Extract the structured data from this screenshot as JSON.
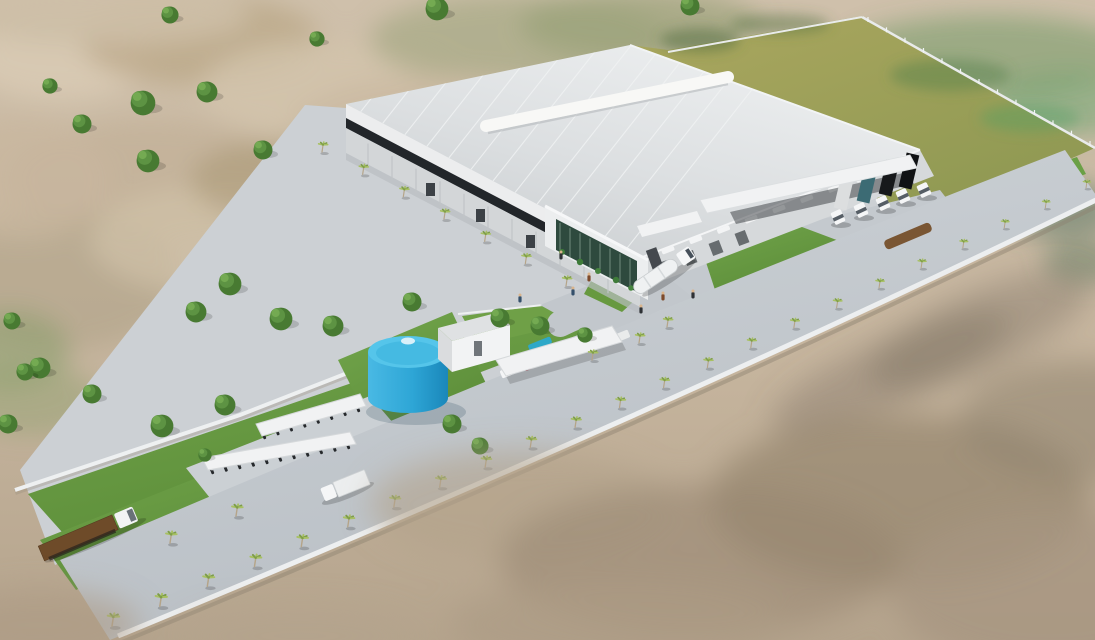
{
  "scene": {
    "type": "3d-architectural-aerial-render",
    "description": "Aerial 3D rendering of an industrial warehouse facility: white standing-seam roof with ridge ventilator, glass entrance atrium, loading docks with semi trucks, blue cylindrical water tank, pump house, carports, motorcycle canopies, palm-lined perimeter boulevard with white wall, olive expansion field and blurred sandy scrubland terrain",
    "palette": {
      "sand_base": "#c6b59e",
      "sand_light": "#d9cbb5",
      "sand_dark": "#a3927a",
      "sand_green": "#97a47c",
      "field_olive": "#a7a35c",
      "field_olive_dark": "#8b9751",
      "lawn_green": "#67993f",
      "lawn_light": "#7fae57",
      "lawn_dark": "#4f7f33",
      "road_gray": "#c4c9ce",
      "pad_gray": "#cbd0d4",
      "roof_light": "#e9ebec",
      "roof_shadow": "#c7cbce",
      "roof_seam": "#f0f2f3",
      "ridge_vent_white": "#f8f8f6",
      "fascia_white": "#ecedee",
      "glazing_dark": "#22262a",
      "wall_light": "#d6d9db",
      "pilaster_gray": "#c0c4c7",
      "glass_green": "#2e4a3e",
      "mullion_light": "#a9c2b2",
      "plant_green": "#3e7b39",
      "canopy_white": "#f1f2f3",
      "tank_blue_top": "#55c5ea",
      "tank_blue": "#2ea6d6",
      "tank_blue_dark": "#1786b8",
      "palm_frond": "#a8c162",
      "palm_frond_dark": "#7d9d49",
      "palm_trunk": "#b5a488",
      "tree_green": "#5d9343",
      "tree_green_dark": "#487a32",
      "tree_green_light": "#74aa52",
      "truck_white": "#f5f6f7",
      "trailer_teal": "#3c6b74",
      "trailer_black": "#17191b",
      "trailer_gray": "#dcdedf",
      "trailer_brown": "#6e4b29",
      "hedge_brown": "#7a5633",
      "perimeter_wall_white": "#edeff0",
      "shade_canopy_blue": "#2ea8c8",
      "people_dark": "#2e3135"
    },
    "objects": {
      "warehouse": {
        "label": "main warehouse building",
        "features": [
          "standing-seam metal roof",
          "ridge ventilator",
          "dark clerestory glazing band",
          "glass entrance atrium with vertical garden",
          "loading docks with canopy"
        ]
      },
      "loading_dock": {
        "truck_count": 6,
        "trailer_colors": [
          "gray",
          "teal",
          "black",
          "black"
        ]
      },
      "water_tank": {
        "shape": "cylindrical",
        "color": "blue"
      },
      "pump_house": {
        "color": "white"
      },
      "carport": {
        "car_count": 6
      },
      "motorcycle_canopies": {
        "count": 2
      },
      "flatbed_truck": {
        "trailer_color": "brown"
      },
      "box_truck": {
        "color": "white"
      },
      "tanker_truck": {
        "color": "white"
      },
      "perimeter_road": {
        "palm_count": 23,
        "wall": "white masonry"
      },
      "expansion_field": {
        "color": "olive-green",
        "fenced": true
      },
      "terrain": {
        "type": "sandy scrubland with scattered trees, foreground depth-of-field blur"
      }
    }
  },
  "placements": {
    "terrain_trees": [
      [
        143,
        103,
        13
      ],
      [
        207,
        92,
        11
      ],
      [
        82,
        124,
        10
      ],
      [
        148,
        161,
        12
      ],
      [
        50,
        86,
        8
      ],
      [
        263,
        150,
        10
      ],
      [
        230,
        284,
        12
      ],
      [
        196,
        312,
        11
      ],
      [
        281,
        319,
        12
      ],
      [
        40,
        368,
        11
      ],
      [
        92,
        394,
        10
      ],
      [
        12,
        321,
        9
      ],
      [
        437,
        9,
        12
      ],
      [
        690,
        6,
        10
      ],
      [
        170,
        15,
        9
      ],
      [
        317,
        39,
        8
      ],
      [
        8,
        424,
        10
      ],
      [
        25,
        372,
        9
      ]
    ],
    "site_trees": [
      [
        333,
        326,
        11
      ],
      [
        412,
        302,
        10
      ],
      [
        500,
        318,
        10
      ],
      [
        540,
        326,
        10
      ],
      [
        452,
        424,
        10
      ],
      [
        480,
        446,
        9
      ],
      [
        162,
        426,
        12
      ],
      [
        225,
        405,
        11
      ],
      [
        585,
        335,
        8
      ],
      [
        205,
        455,
        7
      ]
    ],
    "palms_main": {
      "p0": [
        112,
        626
      ],
      "p1": [
        640,
        408
      ],
      "p2": [
        1086,
        188
      ],
      "count": 23
    },
    "palms_inner": [
      [
        592,
        360
      ],
      [
        639,
        343
      ],
      [
        667,
        327
      ]
    ],
    "palms_facade": {
      "from": [
        322,
        152
      ],
      "to": [
        566,
        286
      ],
      "count": 7
    },
    "palms_extra": [
      [
        170,
        543
      ],
      [
        236,
        516
      ]
    ],
    "dock_trucks": {
      "cabs": [
        [
          838,
          217
        ],
        [
          861,
          210
        ],
        [
          883,
          203
        ],
        [
          903,
          196
        ],
        [
          924,
          190
        ]
      ],
      "trailer_colors": [
        "#dcdedf",
        "#3c6b74",
        "#17191b",
        "#101214",
        null
      ]
    },
    "cars": {
      "from": [
        508,
        372
      ],
      "to": [
        622,
        336
      ],
      "colors": [
        "#f4f5f6",
        "#7e2330",
        "#23262a",
        "#d0d3d5",
        "#f4f5f6",
        "#e9ebeb"
      ]
    },
    "motos_row1": {
      "from": [
        264,
        436
      ],
      "to": [
        358,
        409
      ],
      "count": 8
    },
    "motos_row2": {
      "from": [
        212,
        471
      ],
      "to": [
        348,
        446
      ],
      "count": 11
    },
    "people": {
      "positions": [
        [
          561,
          257
        ],
        [
          589,
          279
        ],
        [
          573,
          293
        ],
        [
          641,
          311
        ],
        [
          663,
          298
        ],
        [
          693,
          296
        ],
        [
          520,
          300
        ]
      ],
      "colors": [
        "#2e3135",
        "#7d4a2b",
        "#35506b",
        "#2e3135",
        "#7d4a2b",
        "#2e3135",
        "#35506b"
      ]
    },
    "roof_seams": {
      "count": 13
    },
    "facade_pilasters": {
      "count": 11
    },
    "portal_mullions": {
      "count": 8
    },
    "ribbon_windows": {
      "from": [
        668,
        250
      ],
      "to": [
        890,
        168
      ],
      "count": 9
    },
    "dock_recesses": [
      [
        664,
        268
      ],
      [
        690,
        258
      ],
      [
        716,
        248
      ],
      [
        742,
        238
      ]
    ],
    "fence_posts": {
      "from": [
        868,
        22
      ],
      "to": [
        1090,
        146
      ],
      "count": 13
    }
  }
}
